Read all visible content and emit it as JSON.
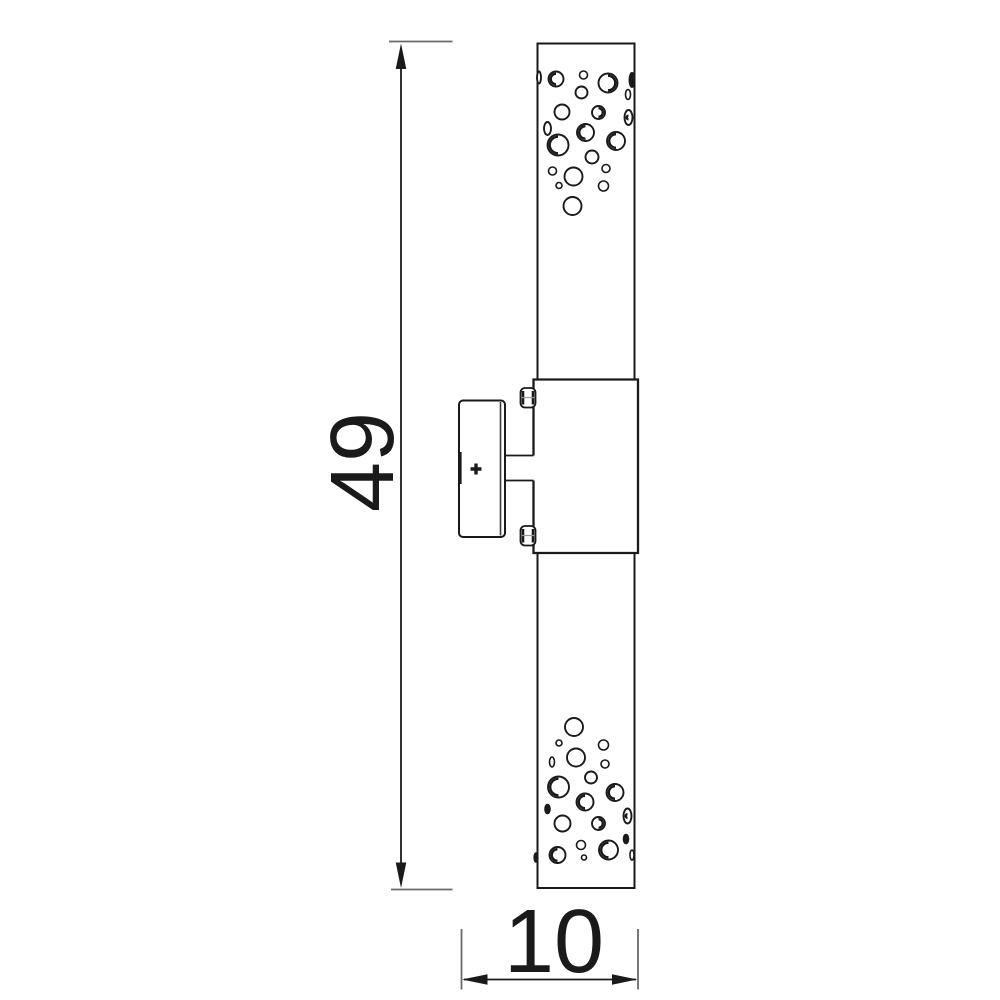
{
  "drawing": {
    "title": "Wall light fixture - side elevation technical drawing",
    "dimensions": {
      "height_label": "49",
      "depth_label": "10"
    },
    "colors": {
      "line": "#1a1a1a",
      "extension_line": "#6a6a6a",
      "screw_midline": "#9a9a9a",
      "background": "#ffffff"
    },
    "perforations": {
      "top": [
        {
          "cx": 539,
          "cy": 77.5,
          "rx": 2,
          "ry": 6,
          "style": "plain"
        },
        {
          "cx": 556,
          "cy": 79,
          "r": 7.5,
          "style": "shaded"
        },
        {
          "cx": 583.5,
          "cy": 75,
          "r": 4,
          "style": "plain"
        },
        {
          "cx": 608,
          "cy": 83,
          "r": 9.5,
          "style": "shaded-right"
        },
        {
          "cx": 632,
          "cy": 80,
          "rx": 2.5,
          "ry": 7,
          "style": "dark"
        },
        {
          "cx": 581.5,
          "cy": 92.5,
          "r": 6,
          "style": "plain"
        },
        {
          "cx": 628,
          "cy": 94.5,
          "rx": 2.5,
          "ry": 5,
          "style": "plain"
        },
        {
          "cx": 562,
          "cy": 112,
          "r": 7.5,
          "style": "plain"
        },
        {
          "cx": 598.5,
          "cy": 112.5,
          "r": 6.5,
          "style": "shaded-right"
        },
        {
          "cx": 628.5,
          "cy": 117.5,
          "rx": 4,
          "ry": 7.5,
          "style": "shaded"
        },
        {
          "cx": 547.5,
          "cy": 128.5,
          "rx": 3.5,
          "ry": 6.5,
          "style": "plain"
        },
        {
          "cx": 585.5,
          "cy": 132.5,
          "r": 8.5,
          "style": "shaded"
        },
        {
          "cx": 616,
          "cy": 141,
          "r": 9,
          "style": "shaded"
        },
        {
          "cx": 558,
          "cy": 145,
          "r": 10.5,
          "style": "shaded"
        },
        {
          "cx": 592,
          "cy": 157,
          "r": 6.5,
          "style": "plain"
        },
        {
          "cx": 552.5,
          "cy": 171,
          "r": 4,
          "style": "plain"
        },
        {
          "cx": 573.5,
          "cy": 176.5,
          "r": 9,
          "style": "plain"
        },
        {
          "cx": 606,
          "cy": 168.5,
          "r": 4,
          "style": "plain"
        },
        {
          "cx": 559,
          "cy": 185.5,
          "r": 3,
          "style": "plain"
        },
        {
          "cx": 603.5,
          "cy": 186,
          "r": 5,
          "style": "plain"
        },
        {
          "cx": 572.5,
          "cy": 206,
          "r": 9,
          "style": "plain"
        }
      ],
      "bottom": [
        {
          "cx": 574,
          "cy": 727,
          "r": 9,
          "style": "plain"
        },
        {
          "cx": 559,
          "cy": 743,
          "r": 3,
          "style": "plain"
        },
        {
          "cx": 603.5,
          "cy": 745,
          "r": 5,
          "style": "plain"
        },
        {
          "cx": 552,
          "cy": 762,
          "rx": 2.5,
          "ry": 5,
          "style": "plain"
        },
        {
          "cx": 576,
          "cy": 757.5,
          "r": 9,
          "style": "plain"
        },
        {
          "cx": 605,
          "cy": 764,
          "r": 4,
          "style": "plain"
        },
        {
          "cx": 558.5,
          "cy": 787,
          "r": 10.5,
          "style": "shaded"
        },
        {
          "cx": 591,
          "cy": 777.5,
          "r": 6,
          "style": "plain"
        },
        {
          "cx": 615,
          "cy": 792.5,
          "r": 8.5,
          "style": "shaded"
        },
        {
          "cx": 547.5,
          "cy": 809,
          "rx": 2.5,
          "ry": 4.5,
          "style": "dark"
        },
        {
          "cx": 585,
          "cy": 802,
          "r": 8.5,
          "style": "shaded"
        },
        {
          "cx": 627.5,
          "cy": 816,
          "rx": 4,
          "ry": 7.5,
          "style": "shaded"
        },
        {
          "cx": 562.5,
          "cy": 823.5,
          "r": 8,
          "style": "plain"
        },
        {
          "cx": 598.5,
          "cy": 823.5,
          "r": 6.5,
          "style": "shaded-right"
        },
        {
          "cx": 581,
          "cy": 845,
          "r": 4.5,
          "style": "plain"
        },
        {
          "cx": 626,
          "cy": 839,
          "rx": 2.5,
          "ry": 4.5,
          "style": "dark"
        },
        {
          "cx": 557.5,
          "cy": 855,
          "r": 8,
          "style": "shaded"
        },
        {
          "cx": 584,
          "cy": 857.5,
          "r": 2.5,
          "style": "plain"
        },
        {
          "cx": 608.5,
          "cy": 850,
          "r": 9.5,
          "style": "shaded"
        },
        {
          "cx": 536,
          "cy": 857.5,
          "rx": 1.8,
          "ry": 4.5,
          "style": "dark"
        },
        {
          "cx": 632,
          "cy": 855,
          "rx": 2,
          "ry": 5,
          "style": "shaded"
        }
      ]
    }
  }
}
